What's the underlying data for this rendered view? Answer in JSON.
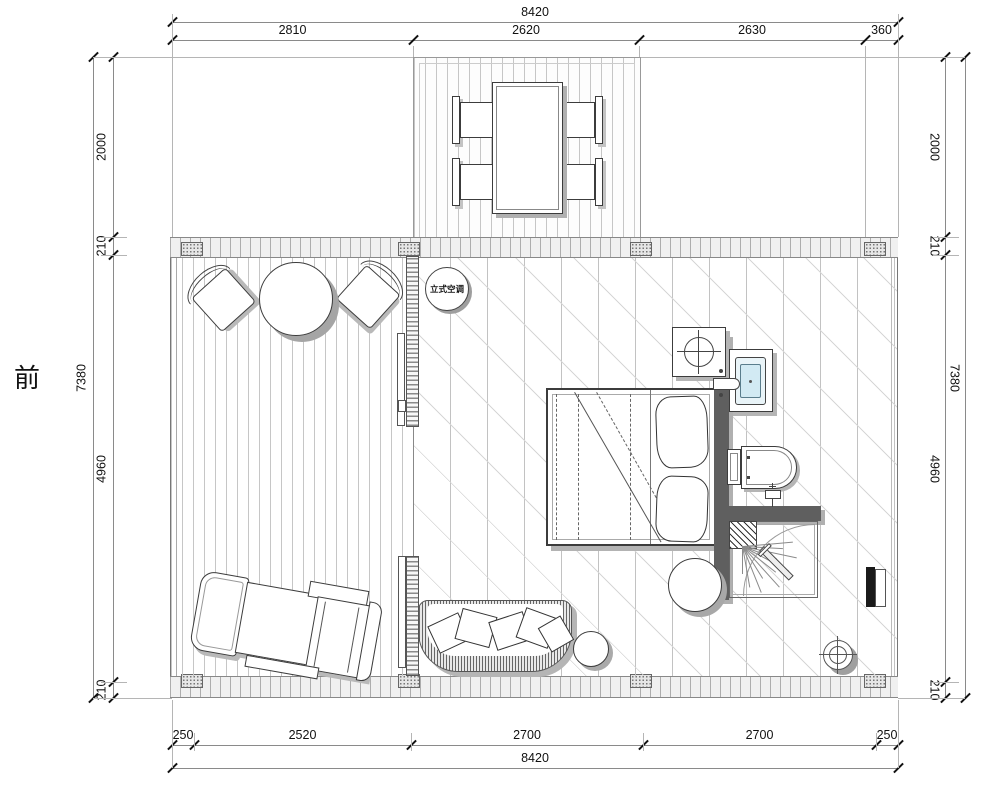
{
  "title": "cabin floor plan",
  "front_label": "前",
  "ac_label": "立式空调",
  "colors": {
    "line_dark": "#3c3c3c",
    "wall_gray": "#5f5f5f",
    "plank_gray": "#c6c6c6",
    "basin_blue": "#d2eaf3",
    "shadow_gray": "#b0b0b0",
    "text": "#111111"
  },
  "dimensions": {
    "top_total": {
      "axis": "h",
      "line": 22,
      "bounds": [
        172,
        898
      ],
      "labels": [
        "8420"
      ]
    },
    "top_row": {
      "axis": "h",
      "line": 40,
      "bounds": [
        172,
        413,
        639,
        865,
        898
      ],
      "labels": [
        "2810",
        "2620",
        "2630",
        "360"
      ]
    },
    "bottom_row": {
      "axis": "h",
      "line": 745,
      "bounds": [
        172,
        194,
        411,
        643,
        876,
        898
      ],
      "labels": [
        "250",
        "2520",
        "2700",
        "2700",
        "250"
      ]
    },
    "bottom_total": {
      "axis": "h",
      "line": 768,
      "bounds": [
        172,
        898
      ],
      "labels": [
        "8420"
      ]
    },
    "left_total": {
      "axis": "v",
      "side": "left",
      "line": 93,
      "bounds": [
        57,
        698
      ],
      "labels": [
        "7380"
      ]
    },
    "left_row": {
      "axis": "v",
      "side": "left",
      "line": 113,
      "bounds": [
        57,
        237,
        255,
        682,
        698
      ],
      "labels": [
        "2000",
        "210",
        "4960",
        "210"
      ]
    },
    "right_row": {
      "axis": "v",
      "side": "right",
      "line": 945,
      "bounds": [
        57,
        237,
        255,
        682,
        698
      ],
      "labels": [
        "2000",
        "210",
        "4960",
        "210"
      ]
    },
    "right_total": {
      "axis": "v",
      "side": "right",
      "line": 965,
      "bounds": [
        57,
        698
      ],
      "labels": [
        "7380"
      ]
    }
  }
}
